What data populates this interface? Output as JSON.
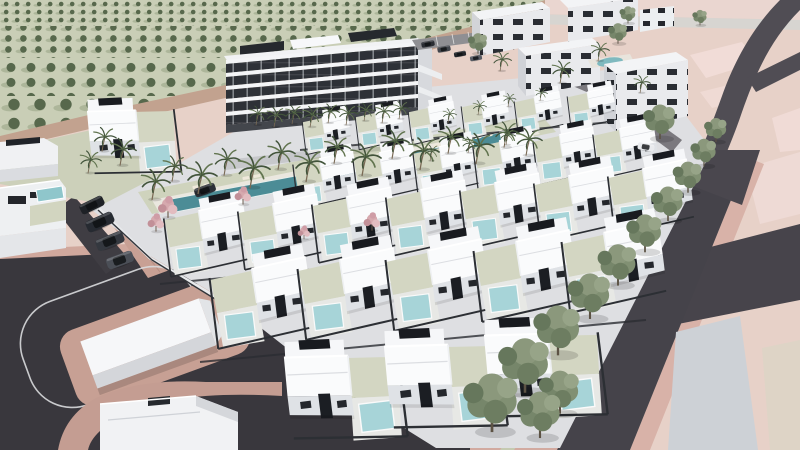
{
  "meta": {
    "description": "Aerial 3D architectural render of a new-build residential development: rows of white villas with private pools, a five-storey apartment building with communal pool, apartment blocks, olive grove, roads and a landscaped boulevard",
    "canvas": {
      "width": 800,
      "height": 450
    }
  },
  "palette": {
    "terrain_pink": "#e7d1c8",
    "terrain_pink_light": "#f1dcd7",
    "sidewalk_pink": "#d2aaa0",
    "sidewalk_pink_dark": "#c8a094",
    "road_dark": "#39373d",
    "road_mid": "#45434a",
    "road_pale": "#d7d5d1",
    "dirt_track": "#c2a28f",
    "grove_ground": "#c9ceb6",
    "grove_tree": "#57684c",
    "grove_shadow": "#a6b093",
    "deck": "#eae7df",
    "pool_communal": "#4c8c96",
    "pool_villa": "#a7d4d8",
    "villa_white": "#fafbfc",
    "villa_face": "#dfe2e6",
    "villa_dark": "#1b1e23",
    "apartment_white": "#f1f2f4",
    "apartment_glass": "#2e3137",
    "block_face": "#e9eaed",
    "block_side": "#d2d4d8",
    "street_tree_green": "#819073",
    "palm_green": "#42543b",
    "pink_tree": "#d6a9ae",
    "sage_verge": "#c5cab1",
    "gray_lot": "#cdd1d6",
    "beige_lot": "#ded4c6",
    "island_pink": "#c7a094",
    "car_dark": "#262a31"
  },
  "scene": {
    "villaRows": [
      {
        "name": "back-row",
        "count": 6,
        "x": 300,
        "y": 112,
        "dx": 53,
        "dy": -5,
        "s": 0.48,
        "rot": -7,
        "flip": false
      },
      {
        "name": "row-2",
        "count": 6,
        "x": 290,
        "y": 152,
        "dx": 60,
        "dy": -6,
        "s": 0.64,
        "rot": -7,
        "flip": false
      },
      {
        "name": "row-3",
        "count": 7,
        "x": 160,
        "y": 202,
        "dx": 74,
        "dy": -7,
        "s": 0.84,
        "rot": -7,
        "flip": false
      },
      {
        "name": "row-4",
        "count": 5,
        "x": 205,
        "y": 258,
        "dx": 88,
        "dy": -9,
        "s": 1.02,
        "rot": -7,
        "flip": false
      },
      {
        "name": "front-row",
        "count": 3,
        "x": 280,
        "y": 345,
        "dx": 100,
        "dy": -11,
        "s": 1.18,
        "rot": -7,
        "flip": true
      },
      {
        "name": "west-villa",
        "count": 1,
        "x": 84,
        "y": 102,
        "dx": 0,
        "dy": 0,
        "s": 0.9,
        "rot": -7,
        "flip": true
      }
    ],
    "palms": [
      [
        256,
        124,
        0.6
      ],
      [
        274,
        126,
        0.62
      ],
      [
        292,
        123,
        0.58
      ],
      [
        310,
        126,
        0.65
      ],
      [
        328,
        122,
        0.6
      ],
      [
        346,
        124,
        0.62
      ],
      [
        364,
        120,
        0.56
      ],
      [
        382,
        122,
        0.6
      ],
      [
        399,
        118,
        0.55
      ],
      [
        152,
        198,
        0.95
      ],
      [
        172,
        180,
        0.8
      ],
      [
        198,
        192,
        1.0
      ],
      [
        224,
        174,
        0.85
      ],
      [
        250,
        186,
        1.05
      ],
      [
        278,
        168,
        0.9
      ],
      [
        306,
        180,
        1.0
      ],
      [
        334,
        162,
        0.85
      ],
      [
        362,
        174,
        1.0
      ],
      [
        392,
        157,
        0.9
      ],
      [
        420,
        168,
        1.0
      ],
      [
        448,
        152,
        0.85
      ],
      [
        476,
        162,
        0.95
      ],
      [
        504,
        146,
        0.8
      ],
      [
        526,
        154,
        0.85
      ],
      [
        102,
        150,
        0.75
      ],
      [
        120,
        164,
        0.85
      ],
      [
        88,
        172,
        0.7
      ],
      [
        500,
        70,
        0.6
      ],
      [
        560,
        82,
        0.7
      ],
      [
        598,
        60,
        0.6
      ],
      [
        640,
        92,
        0.55
      ],
      [
        448,
        122,
        0.45
      ],
      [
        478,
        114,
        0.45
      ],
      [
        508,
        106,
        0.42
      ],
      [
        540,
        100,
        0.4
      ],
      [
        430,
        160,
        0.5
      ],
      [
        468,
        152,
        0.5
      ],
      [
        506,
        144,
        0.5
      ]
    ],
    "streetTrees": [
      [
        628,
        22,
        0.5
      ],
      [
        700,
        24,
        0.45
      ],
      [
        618,
        42,
        0.6
      ],
      [
        478,
        52,
        0.6
      ],
      [
        716,
        140,
        0.7
      ],
      [
        660,
        136,
        1.0
      ],
      [
        704,
        164,
        0.8
      ],
      [
        688,
        190,
        0.9
      ],
      [
        668,
        218,
        1.0
      ],
      [
        645,
        249,
        1.1
      ],
      [
        618,
        282,
        1.2
      ],
      [
        590,
        315,
        1.32
      ],
      [
        558,
        351,
        1.45
      ],
      [
        525,
        388,
        1.58
      ],
      [
        560,
        410,
        1.25
      ],
      [
        492,
        427,
        1.7
      ],
      [
        540,
        434,
        1.35
      ]
    ],
    "pinkTrees": [
      [
        168,
        216,
        0.95
      ],
      [
        156,
        230,
        0.8
      ],
      [
        243,
        203,
        0.8
      ],
      [
        372,
        229,
        0.8
      ],
      [
        304,
        238,
        0.6
      ]
    ],
    "cars": [
      {
        "x": 100,
        "y": 222,
        "s": 1.2,
        "a": -24,
        "c": "#262a31"
      },
      {
        "x": 110,
        "y": 241,
        "s": 1.2,
        "a": -22,
        "c": "#34383f"
      },
      {
        "x": 120,
        "y": 260,
        "s": 1.15,
        "a": -20,
        "c": "#4b4f57"
      },
      {
        "x": 92,
        "y": 205,
        "s": 1.05,
        "a": -26,
        "c": "#1e2126"
      },
      {
        "x": 205,
        "y": 190,
        "s": 0.9,
        "a": -20,
        "c": "#2b2f36"
      },
      {
        "x": 428,
        "y": 44,
        "s": 0.55,
        "a": -10,
        "c": "#2a2d33"
      },
      {
        "x": 444,
        "y": 49,
        "s": 0.55,
        "a": -10,
        "c": "#41454c"
      },
      {
        "x": 460,
        "y": 54,
        "s": 0.5,
        "a": -10,
        "c": "#22252a"
      },
      {
        "x": 476,
        "y": 58,
        "s": 0.5,
        "a": -10,
        "c": "#575b63"
      },
      {
        "x": 646,
        "y": 147,
        "s": 0.7,
        "a": 10,
        "c": "#e9ebee"
      }
    ],
    "loungers": [
      [
        196,
        187
      ],
      [
        207,
        185
      ],
      [
        246,
        178
      ],
      [
        257,
        176
      ],
      [
        306,
        169
      ],
      [
        317,
        167
      ],
      [
        366,
        157
      ],
      [
        377,
        155
      ],
      [
        426,
        147
      ],
      [
        437,
        145
      ],
      [
        478,
        137
      ],
      [
        489,
        135
      ]
    ]
  }
}
